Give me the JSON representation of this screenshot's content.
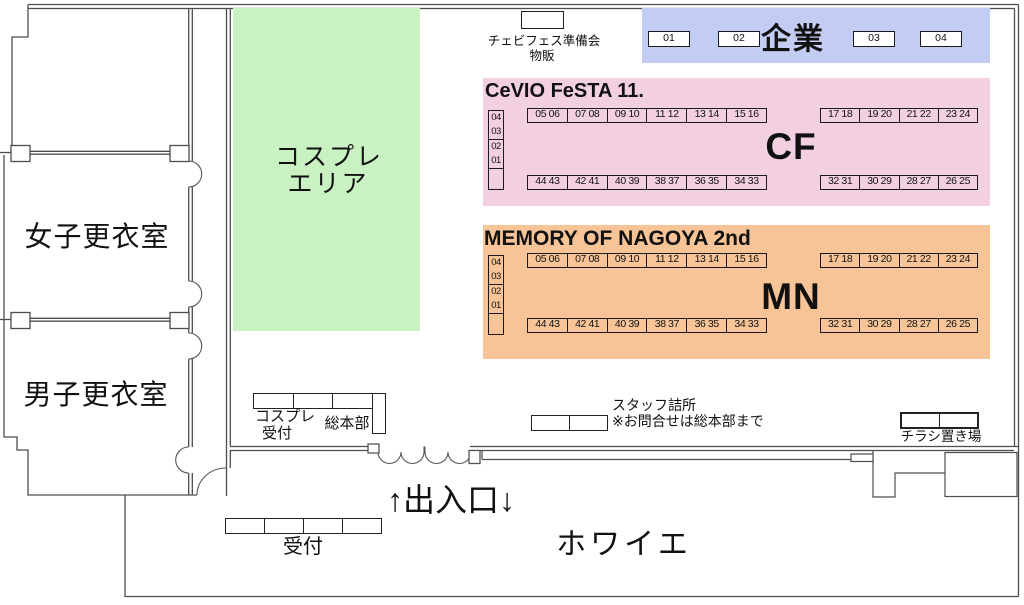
{
  "colors": {
    "cosplay_area_bg": "#c9f1c2",
    "corporate_bg": "#c3cdf3",
    "cf_bg": "#f3d0e1",
    "mn_bg": "#f7c497",
    "wall": "#4d4d4d"
  },
  "areas": {
    "cosplay": {
      "line1": "コスプレ",
      "line2": "エリア"
    },
    "corporate": {
      "label": "企業",
      "booths": [
        "01",
        "02",
        "03",
        "04"
      ]
    },
    "cf": {
      "title": "CeVIO FeSTA 11.",
      "abbr": "CF",
      "side": [
        "04",
        "03",
        "02",
        "01"
      ],
      "top_left": [
        "05 06",
        "07 08",
        "09 10",
        "11 12",
        "13 14",
        "15 16"
      ],
      "top_right": [
        "17 18",
        "19 20",
        "21 22",
        "23 24"
      ],
      "bottom_left": [
        "44 43",
        "42 41",
        "40 39",
        "38 37",
        "36 35",
        "34 33"
      ],
      "bottom_right": [
        "32 31",
        "30 29",
        "28 27",
        "26 25"
      ]
    },
    "mn": {
      "title": "MEMORY OF NAGOYA 2nd",
      "abbr": "MN",
      "side": [
        "04",
        "03",
        "02",
        "01"
      ],
      "top_left": [
        "05 06",
        "07 08",
        "09 10",
        "11 12",
        "13 14",
        "15 16"
      ],
      "top_right": [
        "17 18",
        "19 20",
        "21 22",
        "23 24"
      ],
      "bottom_left": [
        "44 43",
        "42 41",
        "40 39",
        "38 37",
        "36 35",
        "34 33"
      ],
      "bottom_right": [
        "32 31",
        "30 29",
        "28 27",
        "26 25"
      ]
    }
  },
  "rooms": {
    "women": "女子更衣室",
    "men": "男子更衣室",
    "foyer": "ホワイエ"
  },
  "stations": {
    "prep_sales": {
      "line1": "チェビフェス準備会",
      "line2": "物販"
    },
    "cosplay_reception": {
      "line1": "コスプレ",
      "line2": "受付"
    },
    "headquarters": "総本部",
    "staff_room": {
      "line1": "スタッフ詰所",
      "line2": "※お問合せは総本部まで"
    },
    "flyer_place": "チラシ置き場",
    "reception": "受付",
    "entrance": "↑出入口↓"
  }
}
